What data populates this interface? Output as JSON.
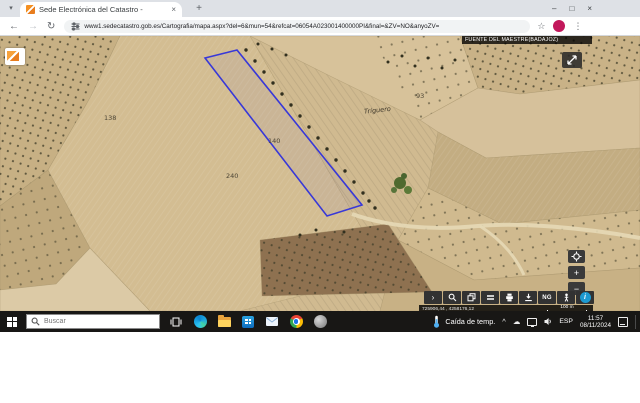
{
  "browser": {
    "tab_title": "Sede Electrónica del Catastro -",
    "url": "www1.sedecatastro.gob.es/Cartografia/mapa.aspx?del=6&mun=54&refcat=06054A023001400000PI&final=&ZV=NO&anyoZV=",
    "icons": {
      "tab_search": "▾",
      "tab_close": "×",
      "new_tab": "+",
      "minimize": "–",
      "maximize": "□",
      "close": "×",
      "back": "←",
      "forward": "→",
      "reload": "↻",
      "star": "☆",
      "menu": "⋮"
    }
  },
  "map": {
    "municipality": "FUENTE DEL MAESTRE(BADAJOZ)",
    "labels": {
      "parcel_138": "138",
      "parcel_140": "140",
      "parcel_240": "240",
      "parcel_93": "93",
      "toponym": "Triguero"
    },
    "controls": {
      "chevron": "›",
      "ng": "NG",
      "info": "i",
      "zoom_in": "+",
      "zoom_out": "−"
    },
    "status": {
      "coordinates": "725906,44 , 4258176,12",
      "scale": "100 m"
    },
    "parcel_outline_color": "#3838d8",
    "info_button_color": "#1d9ad1"
  },
  "taskbar": {
    "search_placeholder": "Buscar",
    "weather": "Caída de temp.",
    "tray_chevron": "^",
    "cloud": "☁",
    "language": "ESP",
    "time": "11:57",
    "date": "08/11/2024"
  }
}
